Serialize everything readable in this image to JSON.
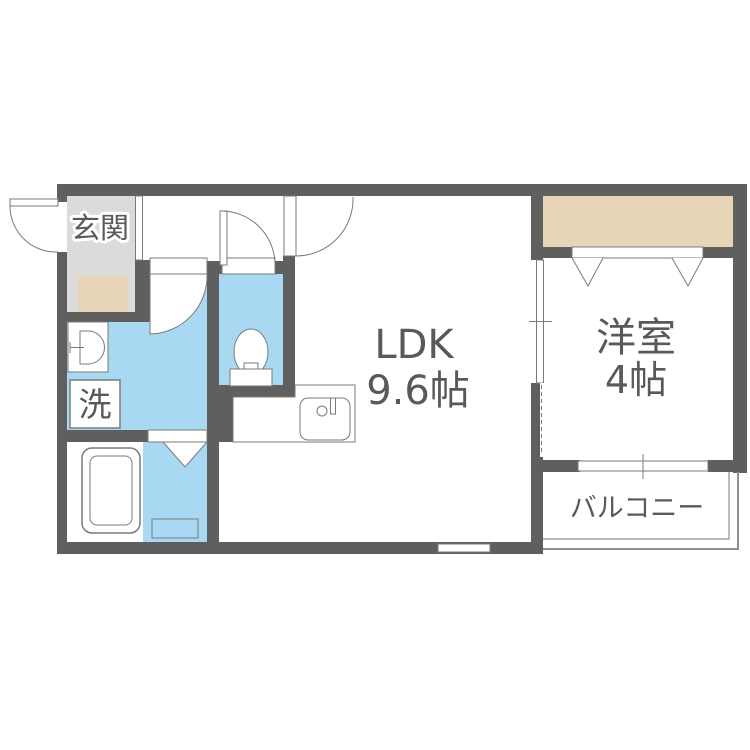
{
  "colors": {
    "wall": "#5f5f5f",
    "line": "#7a7a7a",
    "water": "#a9d9f2",
    "genkan": "#dbdbdb",
    "tatami_mat": "#e8d4b6",
    "rail": "#8f8f8f",
    "text": "#595959"
  },
  "rooms": {
    "genkan": {
      "label": "玄関"
    },
    "laundry": {
      "label": "洗"
    },
    "ldk": {
      "label": "LDK",
      "size": "9.6帖"
    },
    "western_room": {
      "label": "洋室",
      "size": "4帖"
    },
    "balcony": {
      "label": "バルコニー"
    }
  }
}
